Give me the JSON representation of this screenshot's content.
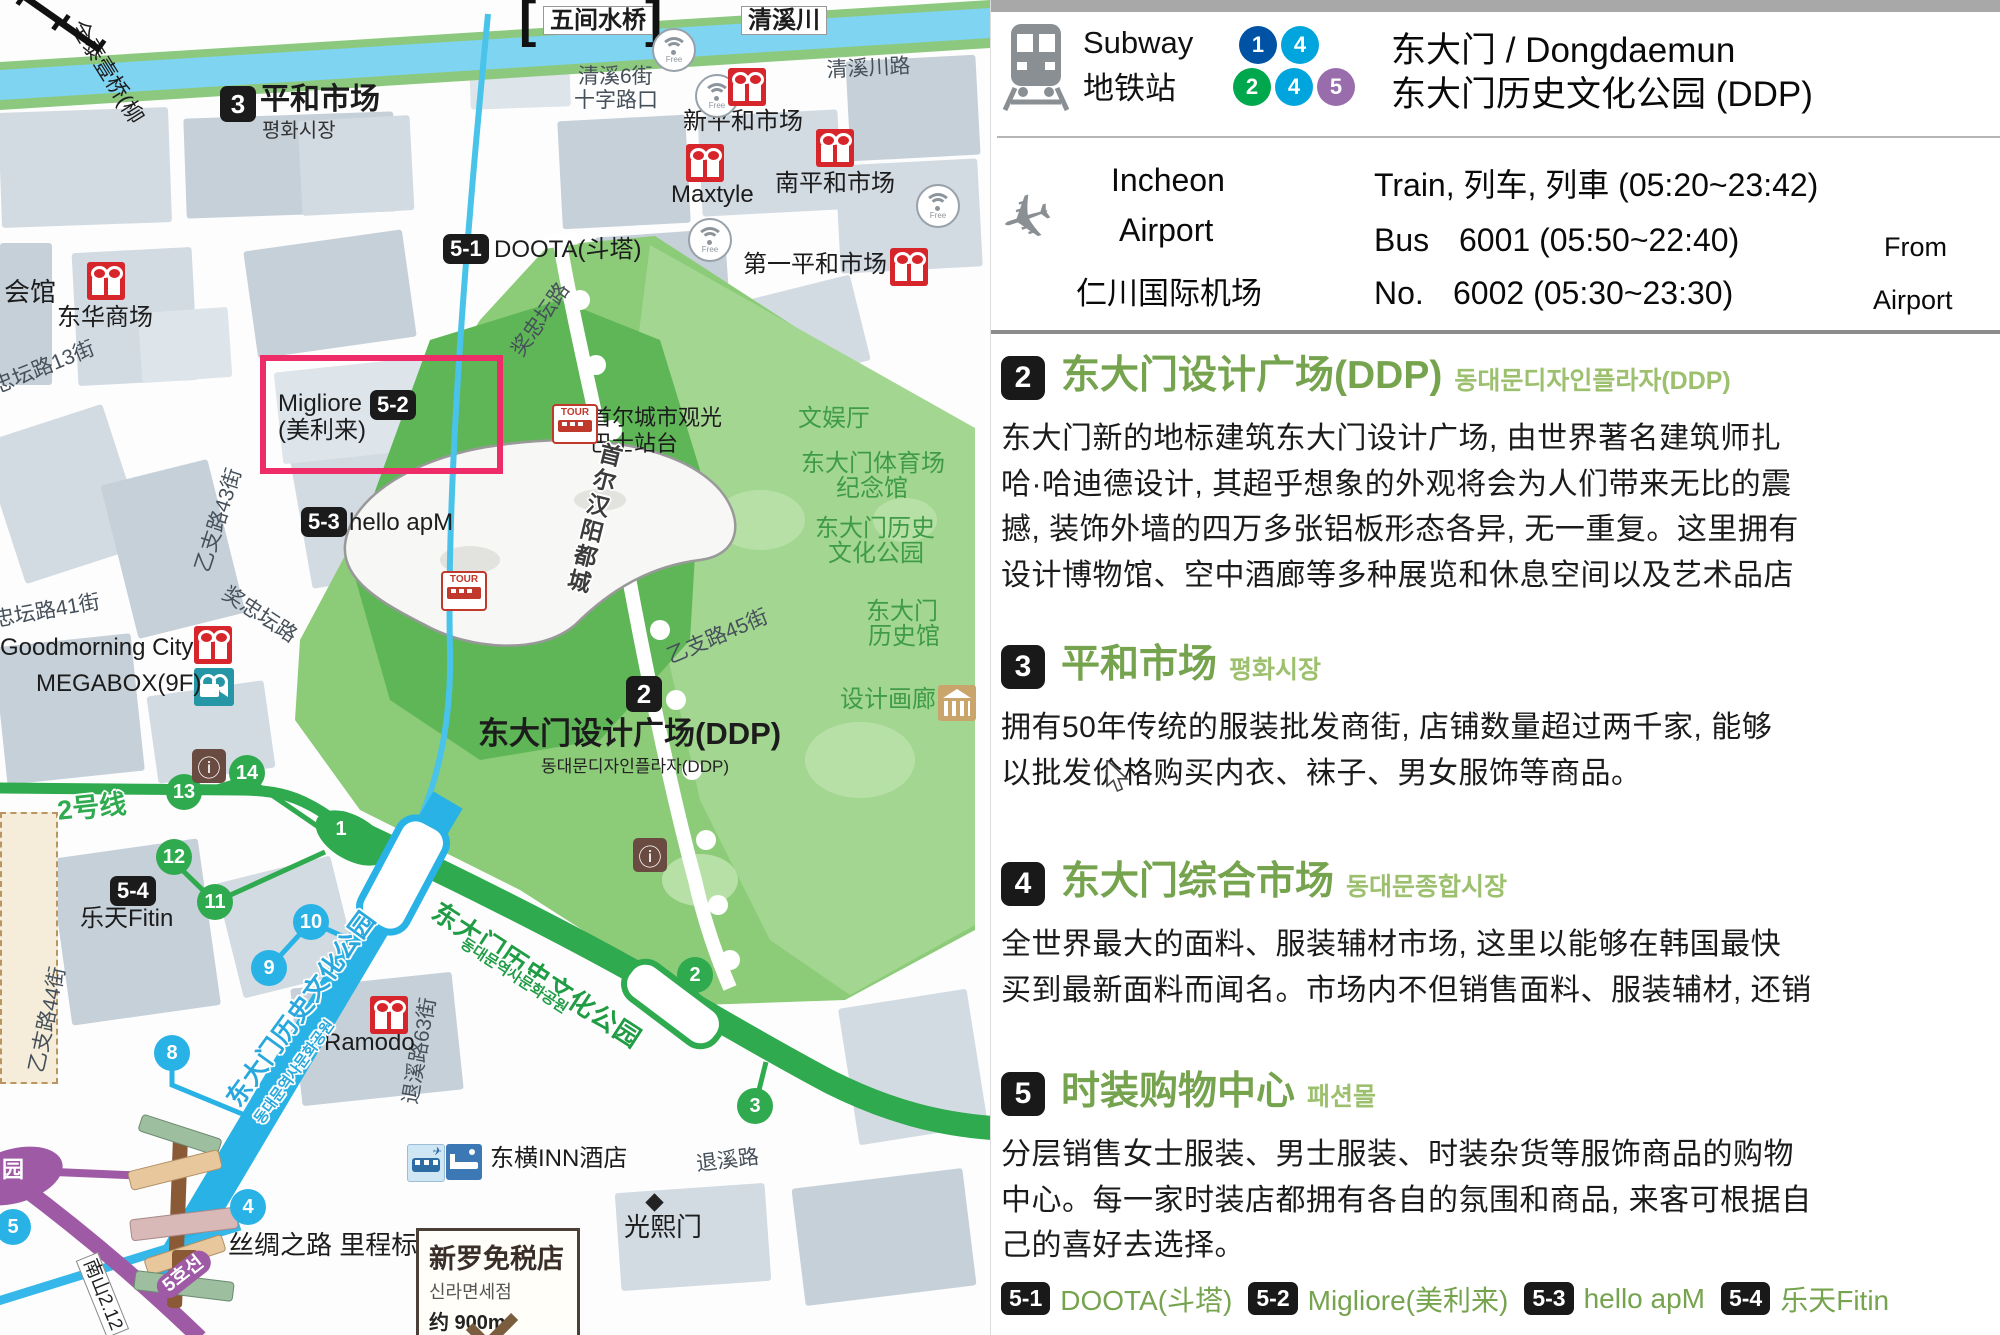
{
  "panel": {
    "subway": {
      "label_en": "Subway",
      "label_cn": "地铁站",
      "lines_row1": [
        {
          "n": "1",
          "c": "#0052A4"
        },
        {
          "n": "4",
          "c": "#00A5DE"
        }
      ],
      "lines_row2": [
        {
          "n": "2",
          "c": "#00A84D"
        },
        {
          "n": "4",
          "c": "#00A5DE"
        },
        {
          "n": "5",
          "c": "#996CAC"
        }
      ],
      "title_line1": "东大门 / Dongdaemun",
      "title_line2": "东大门历史文化公园 (DDP)"
    },
    "airport": {
      "name_en1": "Incheon",
      "name_en2": "Airport",
      "name_cn": "仁川国际机场",
      "train_line": "Train, 列车, 列車 (05:20~23:42)",
      "bus_word": "Bus",
      "no_word": "No.",
      "bus1": "6001 (05:50~22:40)",
      "bus2": "6002 (05:30~23:30)",
      "from1": "From",
      "from2": "Airport"
    },
    "sections": [
      {
        "num": "2",
        "title": "东大门设计广场(DDP)",
        "title_kr": "동대문디자인플라자(DDP)",
        "body": [
          "东大门新的地标建筑东大门设计广场, 由世界著名建筑师扎",
          "哈·哈迪德设计, 其超乎想象的外观将会为人们带来无比的震",
          "撼, 装饰外墙的四万多张铝板形态各异, 无一重复。这里拥有",
          "设计博物馆、空中酒廊等多种展览和休息空间以及艺术品店"
        ]
      },
      {
        "num": "3",
        "title": "平和市场",
        "title_kr": "평화시장",
        "body": [
          "拥有50年传统的服装批发商街, 店铺数量超过两千家, 能够",
          "以批发价格购买内衣、袜子、男女服饰等商品。"
        ]
      },
      {
        "num": "4",
        "title": "东大门综合市场",
        "title_kr": "동대문종합시장",
        "body": [
          "全世界最大的面料、服装辅材市场, 这里以能够在韩国最快",
          "买到最新面料而闻名。市场内不但销售面料、服装辅材, 还销"
        ]
      },
      {
        "num": "5",
        "title": "时装购物中心",
        "title_kr": "패션몰",
        "body": [
          "分层销售女士服装、男士服装、时装杂货等服饰商品的购物",
          "中心。每一家时装店都拥有各自的氛围和商品, 来客可根据自",
          "己的喜好去选择。"
        ],
        "list": [
          {
            "badge": "5-1",
            "label": "DOOTA(斗塔)"
          },
          {
            "badge": "5-2",
            "label": "Migliore(美利来)"
          },
          {
            "badge": "5-3",
            "label": "hello apM"
          },
          {
            "badge": "5-4",
            "label": "乐天Fitin"
          }
        ]
      }
    ]
  },
  "map": {
    "colors": {
      "line2": "#2faa4e",
      "line4": "#29b2e5",
      "line5": "#9f5aa5",
      "river": "#7fd4f2",
      "park": "#8ccb78",
      "market_icon": "#d6252b",
      "highlight_box": "#ee2d68"
    },
    "signboard": {
      "l1": "新罗免税店",
      "l2": "신라면세점",
      "l3": "约 900m"
    },
    "labels": [
      {
        "t": "清溪川路",
        "x": 826,
        "y": 60,
        "r": -3,
        "c": "r",
        "n": "road-cheonggyecheon-ro"
      },
      {
        "t": "清溪6街",
        "x": 578,
        "y": 66,
        "r": 0,
        "c": "r",
        "n": "road-cheonggye-6"
      },
      {
        "t": "十字路口",
        "x": 574,
        "y": 90,
        "r": 0,
        "c": "r",
        "n": "road-crossroad"
      },
      {
        "t": "忠坛路13街",
        "x": -10,
        "y": 378,
        "r": -22,
        "c": "r",
        "n": "road-13"
      },
      {
        "t": "乙支路43街",
        "x": 192,
        "y": 568,
        "r": -72,
        "c": "r",
        "n": "road-euljiro43"
      },
      {
        "t": "奖忠坛路",
        "x": 230,
        "y": 583,
        "r": 33,
        "c": "r",
        "n": "road-jangchungdan-1"
      },
      {
        "t": "奖忠坛路",
        "x": 508,
        "y": 348,
        "r": -55,
        "c": "r",
        "n": "road-jangchungdan-2"
      },
      {
        "t": "忠坛路41街",
        "x": -8,
        "y": 610,
        "r": -10,
        "c": "r",
        "n": "road-41"
      },
      {
        "t": "乙支路44街",
        "x": 26,
        "y": 1070,
        "r": -78,
        "c": "r",
        "n": "road-euljiro44"
      },
      {
        "t": "退溪路63街",
        "x": 400,
        "y": 1102,
        "r": -80,
        "c": "r",
        "n": "road-toegye63"
      },
      {
        "t": "乙支路45街",
        "x": 664,
        "y": 648,
        "r": -23,
        "c": "r",
        "n": "road-euljiro45"
      },
      {
        "t": "退溪路",
        "x": 695,
        "y": 1154,
        "r": -7,
        "c": "r",
        "n": "road-toegyero"
      },
      {
        "t": "全泰壹桥(柳",
        "x": 86,
        "y": 16,
        "r": 58,
        "c": "p22",
        "n": "bridge-jeontaeil"
      },
      {
        "t": "[",
        "x": 519,
        "y": -8,
        "r": 0,
        "c": "brk",
        "n": "bridge-bracket-left"
      },
      {
        "t": "]",
        "x": 645,
        "y": -8,
        "r": 0,
        "c": "brk",
        "n": "bridge-bracket-right"
      },
      {
        "t": "]",
        "x": 10,
        "y": 0,
        "r": -55,
        "c": "brk",
        "n": "bridge2-bracket-a"
      },
      {
        "t": "[",
        "x": 52,
        "y": 24,
        "r": -55,
        "c": "brk",
        "n": "bridge2-bracket-b"
      },
      {
        "t": "会馆",
        "x": 4,
        "y": 279,
        "r": 0,
        "c": "p26",
        "n": "place-hall"
      },
      {
        "t": "东华商场",
        "x": 57,
        "y": 305,
        "r": 0,
        "c": "p",
        "n": "place-donghwa"
      },
      {
        "t": "平和市场",
        "x": 260,
        "y": 84,
        "r": 0,
        "c": "big",
        "n": "place-pyounghwa"
      },
      {
        "t": "평화시장",
        "x": 262,
        "y": 121,
        "r": 0,
        "c": "kr2",
        "n": "place-pyounghwa-kr"
      },
      {
        "t": "Migliore",
        "x": 278,
        "y": 391,
        "r": 0,
        "c": "p",
        "n": "place-migliore"
      },
      {
        "t": "(美利来)",
        "x": 278,
        "y": 418,
        "r": 0,
        "c": "p",
        "n": "place-migliore-cn"
      },
      {
        "t": "hello apM",
        "x": 349,
        "y": 510,
        "r": 0,
        "c": "p",
        "n": "place-helloapm"
      },
      {
        "t": "DOOTA(斗塔)",
        "x": 494,
        "y": 237,
        "r": 0,
        "c": "p",
        "n": "place-doota"
      },
      {
        "t": "Goodmorning City",
        "x": 0,
        "y": 635,
        "r": 0,
        "c": "p",
        "n": "place-goodmorning"
      },
      {
        "t": "MEGABOX(9F)",
        "x": 36,
        "y": 671,
        "r": 0,
        "c": "p",
        "n": "place-megabox"
      },
      {
        "t": "乐天Fitin",
        "x": 80,
        "y": 906,
        "r": 0,
        "c": "p",
        "n": "place-lottefitin"
      },
      {
        "t": "新平和市场",
        "x": 683,
        "y": 109,
        "r": 0,
        "c": "p",
        "n": "place-shinpyounghwa"
      },
      {
        "t": "Maxtyle",
        "x": 671,
        "y": 182,
        "r": 0,
        "c": "p",
        "n": "place-maxtyle"
      },
      {
        "t": "南平和市场",
        "x": 775,
        "y": 171,
        "r": 0,
        "c": "p",
        "n": "place-nampyounghwa"
      },
      {
        "t": "第一平和市场",
        "x": 743,
        "y": 252,
        "r": 0,
        "c": "p",
        "n": "place-jeil"
      },
      {
        "t": "Ramodo",
        "x": 324,
        "y": 1030,
        "r": 0,
        "c": "p",
        "n": "place-ramodo"
      },
      {
        "t": "东横INN酒店",
        "x": 490,
        "y": 1146,
        "r": 0,
        "c": "p",
        "n": "place-toyoko-inn"
      },
      {
        "t": "光熙门",
        "x": 624,
        "y": 1214,
        "r": 0,
        "c": "p26",
        "n": "place-gwanghuimun"
      },
      {
        "t": "丝绸之路 里程标",
        "x": 228,
        "y": 1232,
        "r": 0,
        "c": "p26",
        "n": "place-silkroad-milestone"
      },
      {
        "t": "首尔城市观光",
        "x": 590,
        "y": 406,
        "r": 0,
        "c": "p22",
        "n": "place-citytour-1"
      },
      {
        "t": "巴士站台",
        "x": 590,
        "y": 432,
        "r": 0,
        "c": "p22",
        "n": "place-citytour-2"
      },
      {
        "t": "文娱厅",
        "x": 798,
        "y": 406,
        "r": 0,
        "c": "g",
        "n": "park-culture-hall"
      },
      {
        "t": "东大门体育场",
        "x": 801,
        "y": 451,
        "r": 0,
        "c": "g",
        "n": "park-stadium-1"
      },
      {
        "t": "纪念馆",
        "x": 836,
        "y": 476,
        "r": 0,
        "c": "g",
        "n": "park-stadium-2"
      },
      {
        "t": "东大门历史",
        "x": 815,
        "y": 516,
        "r": 0,
        "c": "g",
        "n": "park-histpark-1"
      },
      {
        "t": "文化公园",
        "x": 828,
        "y": 541,
        "r": 0,
        "c": "g",
        "n": "park-histpark-2"
      },
      {
        "t": "东大门",
        "x": 866,
        "y": 599,
        "r": 0,
        "c": "g",
        "n": "park-histmuseum-1"
      },
      {
        "t": "历史馆",
        "x": 868,
        "y": 624,
        "r": 0,
        "c": "g",
        "n": "park-histmuseum-2"
      },
      {
        "t": "设计画廊",
        "x": 840,
        "y": 687,
        "r": 0,
        "c": "g",
        "n": "park-design-gallery"
      },
      {
        "t": "东大门设计广场(DDP)",
        "x": 478,
        "y": 718,
        "r": 0,
        "c": "ddpt",
        "n": "ddp-title"
      },
      {
        "t": "동대문디자인플라자(DDP)",
        "x": 541,
        "y": 758,
        "r": 0,
        "c": "ddpk",
        "n": "ddp-title-kr"
      },
      {
        "t": "首尔汉阳都城",
        "x": 600,
        "y": 440,
        "r": 14,
        "c": "wallv halo",
        "n": "wall-label"
      },
      {
        "t": "2号线",
        "x": 56,
        "y": 797,
        "r": -6,
        "c": "l2 halo",
        "n": "line2-label"
      },
      {
        "t": "东大门历史文化公园",
        "x": 442,
        "y": 898,
        "r": 33,
        "c": "gl halo",
        "n": "line2-station-label"
      },
      {
        "t": "동대문역사문화공원",
        "x": 466,
        "y": 936,
        "r": 33,
        "c": "glk halo",
        "n": "line2-station-label-kr"
      },
      {
        "t": "东大门历史文化公园",
        "x": 222,
        "y": 1096,
        "r": -54,
        "c": "bl halo",
        "n": "line4-station-label"
      },
      {
        "t": "동대문역사문화공원",
        "x": 252,
        "y": 1118,
        "r": -54,
        "c": "blk2 halo",
        "n": "line4-station-label-kr"
      },
      {
        "t": "清溪川",
        "x": 741,
        "y": 6,
        "r": 0,
        "c": "wbox",
        "n": "river-label"
      },
      {
        "t": "五间水桥",
        "x": 543,
        "y": 6,
        "r": 0,
        "c": "wbox",
        "n": "bridge-ogansu-label"
      },
      {
        "t": "园",
        "x": 2,
        "y": 1158,
        "r": 0,
        "c": "wht",
        "n": "line5-park-char"
      },
      {
        "t": "南山2.12",
        "x": 98,
        "y": 1252,
        "r": 68,
        "c": "nbox",
        "n": "road-namsan"
      },
      {
        "t": "5호선",
        "x": 152,
        "y": 1284,
        "r": -38,
        "c": "p5",
        "n": "line5-badge"
      }
    ],
    "badges": [
      {
        "t": "3",
        "x": 220,
        "y": 86,
        "sq": 1,
        "n": "badge-3"
      },
      {
        "t": "2",
        "x": 626,
        "y": 676,
        "sq": 1,
        "n": "badge-2"
      },
      {
        "t": "5-1",
        "x": 443,
        "y": 234,
        "n": "badge-5-1"
      },
      {
        "t": "5-2",
        "x": 370,
        "y": 390,
        "n": "badge-5-2"
      },
      {
        "t": "5-3",
        "x": 301,
        "y": 507,
        "n": "badge-5-3"
      },
      {
        "t": "5-4",
        "x": 110,
        "y": 876,
        "n": "badge-5-4"
      }
    ],
    "exits": [
      {
        "t": "14",
        "x": 247,
        "y": 773,
        "c": "g"
      },
      {
        "t": "13",
        "x": 184,
        "y": 792,
        "c": "g"
      },
      {
        "t": "12",
        "x": 174,
        "y": 857,
        "c": "g"
      },
      {
        "t": "11",
        "x": 215,
        "y": 902,
        "c": "g"
      },
      {
        "t": "1",
        "x": 341,
        "y": 829,
        "c": "g"
      },
      {
        "t": "2",
        "x": 695,
        "y": 975,
        "c": "g"
      },
      {
        "t": "3",
        "x": 755,
        "y": 1106,
        "c": "g"
      },
      {
        "t": "10",
        "x": 311,
        "y": 922,
        "c": "b"
      },
      {
        "t": "9",
        "x": 269,
        "y": 968,
        "c": "b"
      },
      {
        "t": "8",
        "x": 172,
        "y": 1053,
        "c": "b"
      },
      {
        "t": "4",
        "x": 248,
        "y": 1207,
        "c": "b"
      },
      {
        "t": "5",
        "x": 13,
        "y": 1227,
        "c": "b"
      }
    ],
    "wifi": [
      {
        "x": 652,
        "y": 28
      },
      {
        "x": 695,
        "y": 74
      },
      {
        "x": 688,
        "y": 218
      },
      {
        "x": 916,
        "y": 184
      }
    ],
    "gifts": [
      {
        "x": 728,
        "y": 68
      },
      {
        "x": 686,
        "y": 144
      },
      {
        "x": 816,
        "y": 129
      },
      {
        "x": 890,
        "y": 248
      },
      {
        "x": 87,
        "y": 262
      },
      {
        "x": 194,
        "y": 626
      },
      {
        "x": 370,
        "y": 996
      }
    ],
    "tour": [
      {
        "x": 552,
        "y": 404
      },
      {
        "x": 441,
        "y": 571
      }
    ],
    "info": [
      {
        "x": 192,
        "y": 749
      },
      {
        "x": 633,
        "y": 838
      }
    ]
  }
}
